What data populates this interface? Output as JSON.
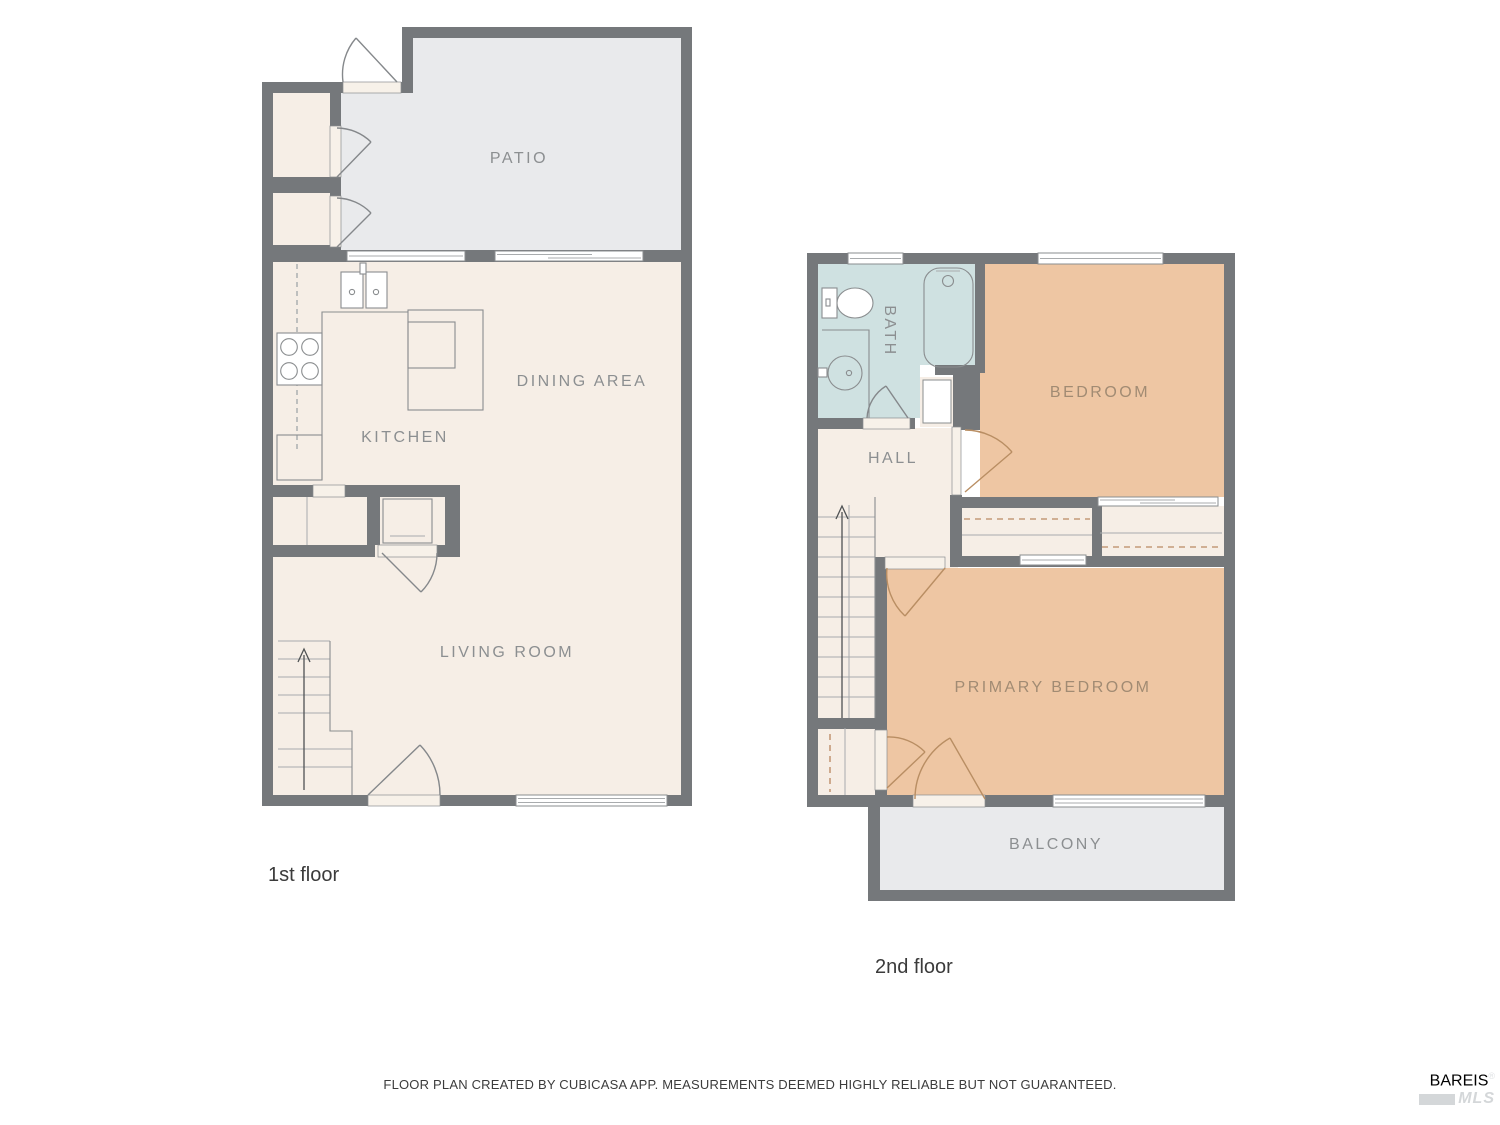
{
  "colors": {
    "wall": "#75787b",
    "patio": "#e9eaec",
    "cream": "#f6eee6",
    "tan": "#eec6a3",
    "bath": "#cfe1e1",
    "threshold": "#f7f1e9",
    "line": "#8a8d8f",
    "arc_gray": "#85888b",
    "arc_brown": "#b98e63",
    "dash_brown": "#c49a78",
    "label_gray": "#8c8f91",
    "label_brown": "#a18b73",
    "caption": "#3b3b3b",
    "logo": "#dfe2e4",
    "logo2": "#d4d7d9"
  },
  "floor1": {
    "caption": "1st floor",
    "rooms": {
      "patio": "PATIO",
      "dining": "DINING AREA",
      "kitchen": "KITCHEN",
      "living": "LIVING ROOM"
    }
  },
  "floor2": {
    "caption": "2nd floor",
    "rooms": {
      "bath": "BATH",
      "bedroom": "BEDROOM",
      "hall": "HALL",
      "primary": "PRIMARY BEDROOM",
      "balcony": "BALCONY"
    }
  },
  "footer": {
    "disclaimer": "FLOOR PLAN CREATED BY CUBICASA APP. MEASUREMENTS DEEMED HIGHLY RELIABLE BUT NOT GUARANTEED."
  },
  "logo": {
    "line1": "BAREIS",
    "reg": "®",
    "line2": "MLS"
  }
}
